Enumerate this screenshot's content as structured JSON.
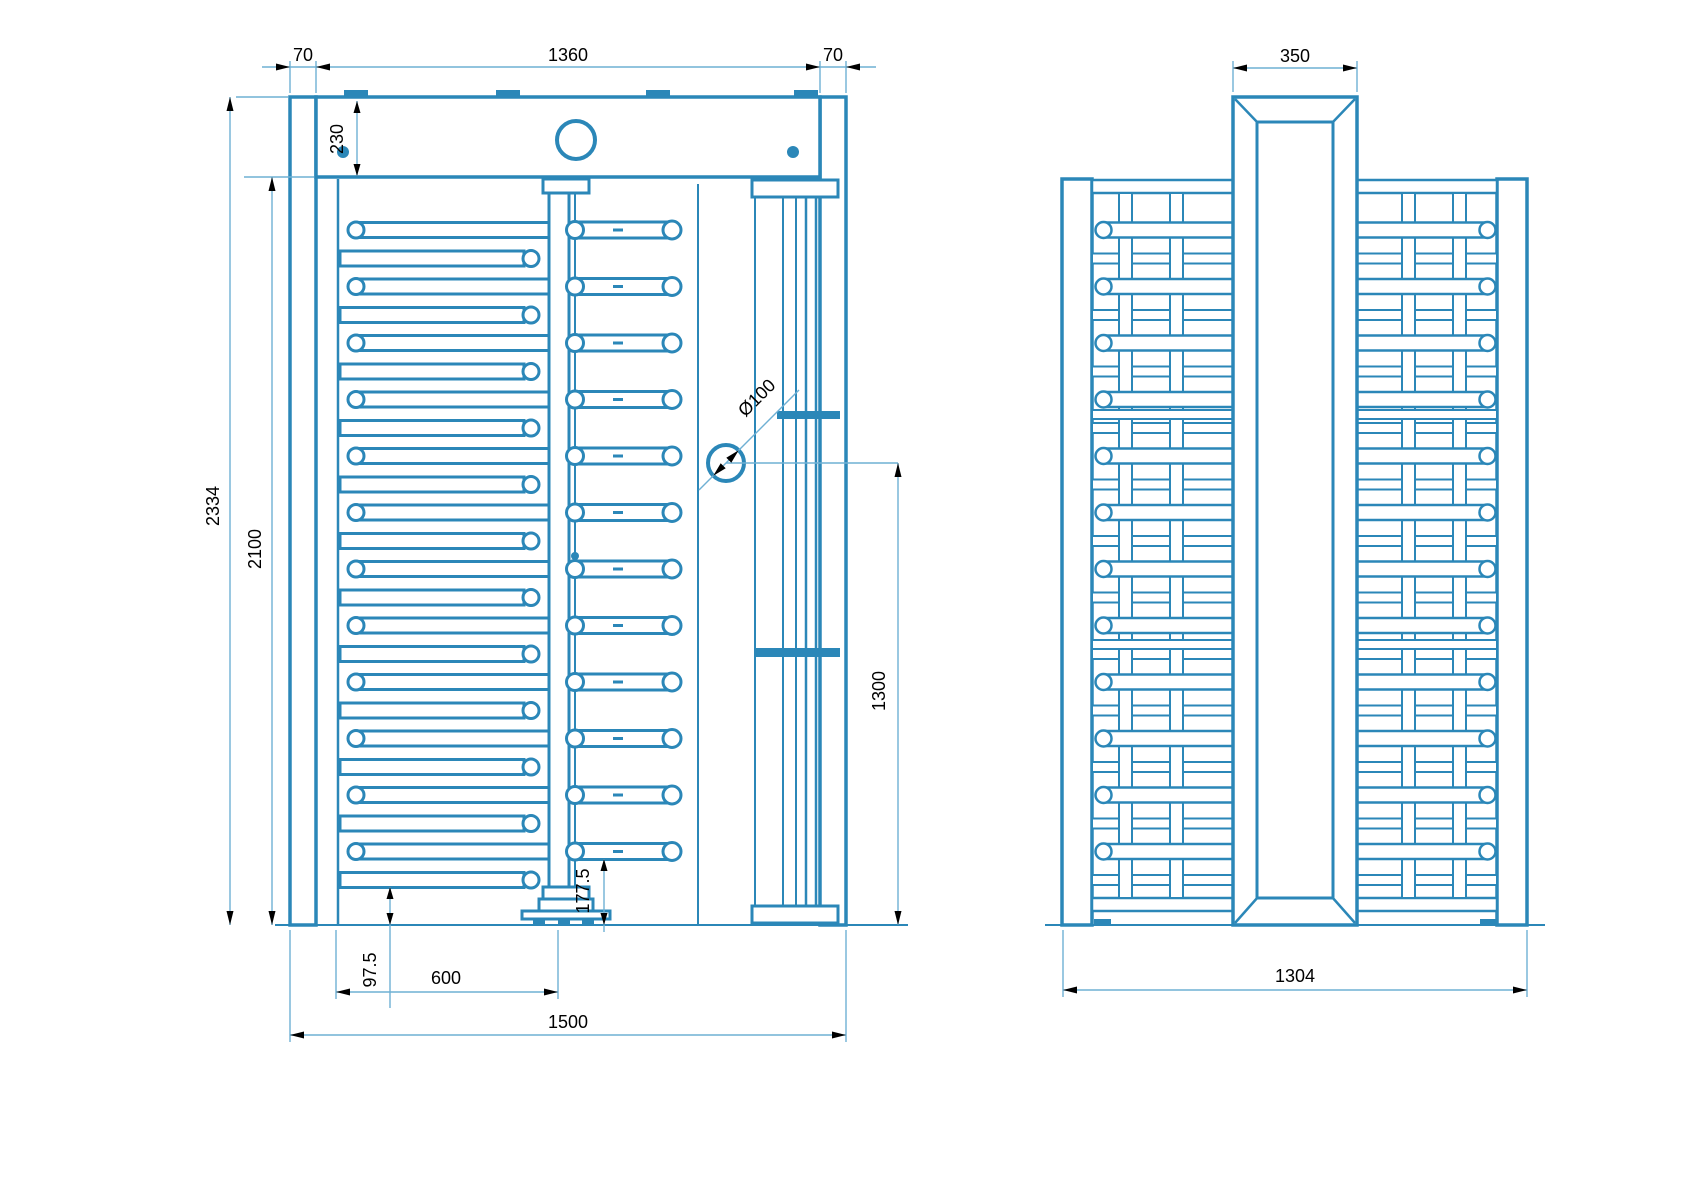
{
  "front_view": {
    "dims": {
      "left_post_width": "70",
      "header_span": "1360",
      "right_post_width": "70",
      "header_height": "230",
      "total_height": "2334",
      "inner_height": "2100",
      "tube_diameter": "Ø100",
      "passage_height": "1300",
      "comb_ground_gap": "97.5",
      "wing_width": "600",
      "arm_ground_gap": "177.5",
      "total_width": "1500"
    }
  },
  "side_view": {
    "dims": {
      "column_width": "350",
      "total_depth": "1304"
    }
  },
  "colors": {
    "line": "#2b87b8",
    "dim_line": "#6fb0d4",
    "text": "#000000",
    "background": "#ffffff"
  }
}
